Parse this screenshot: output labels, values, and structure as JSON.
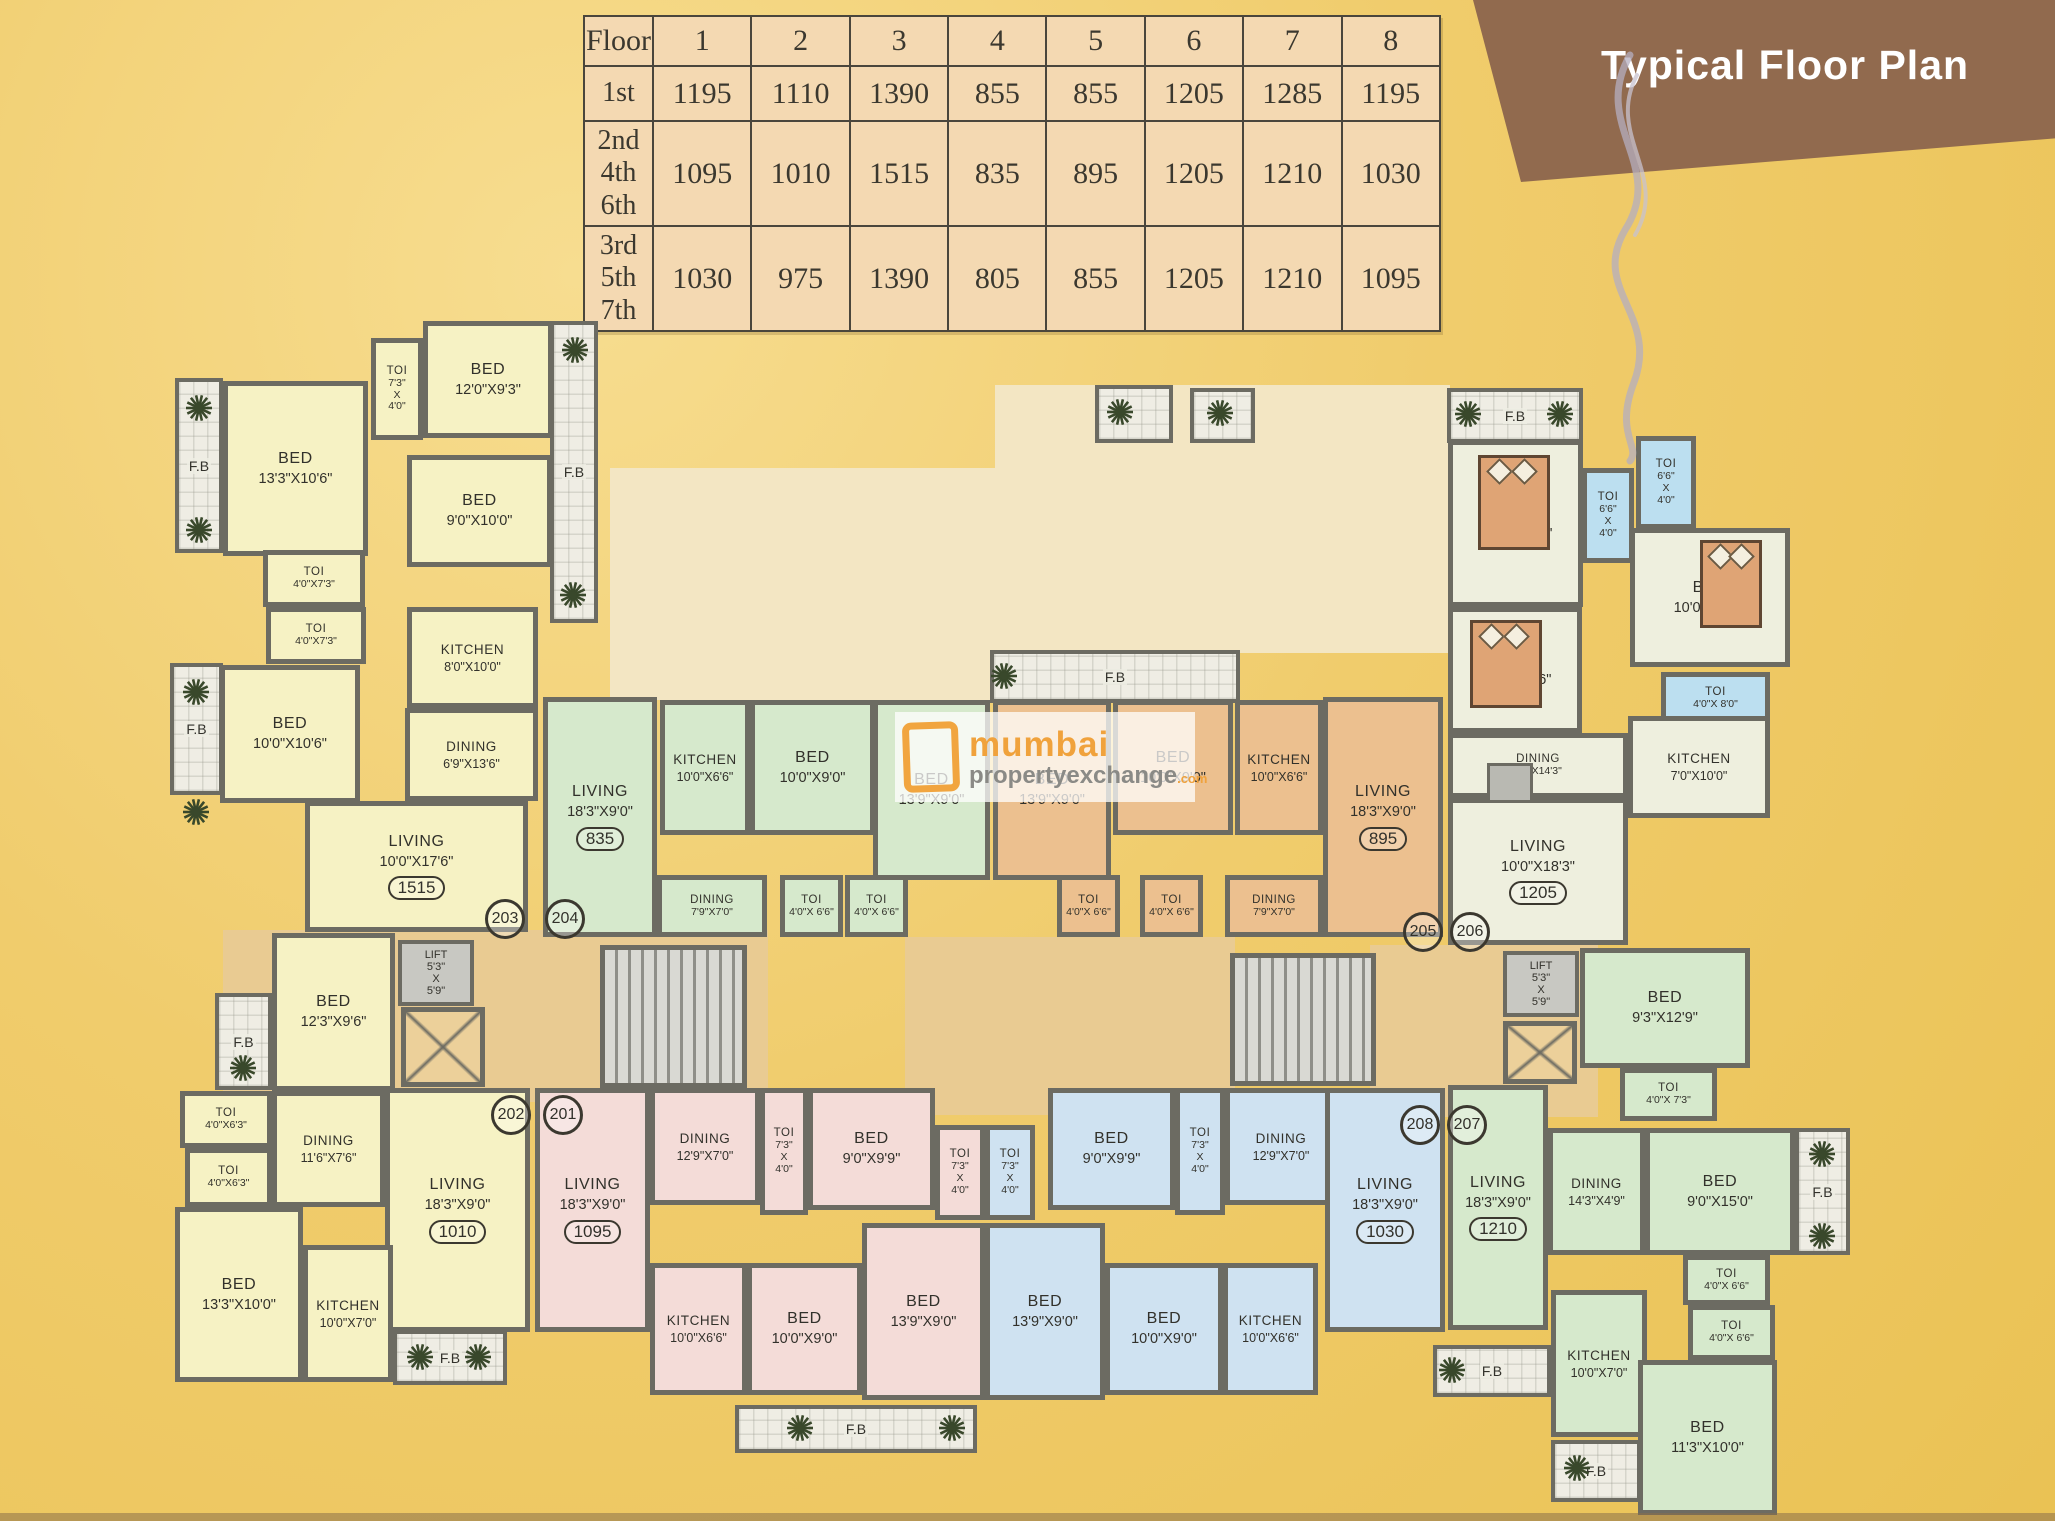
{
  "banner": {
    "title": "Typical Floor Plan"
  },
  "area_table": {
    "header": [
      "Floor",
      "1",
      "2",
      "3",
      "4",
      "5",
      "6",
      "7",
      "8"
    ],
    "rows": [
      {
        "floors": "1st",
        "values": [
          "1195",
          "1110",
          "1390",
          "855",
          "855",
          "1205",
          "1285",
          "1195"
        ]
      },
      {
        "floors": "2nd\n4th\n6th",
        "values": [
          "1095",
          "1010",
          "1515",
          "835",
          "895",
          "1205",
          "1210",
          "1030"
        ]
      },
      {
        "floors": "3rd\n5th\n7th",
        "values": [
          "1030",
          "975",
          "1390",
          "805",
          "855",
          "1205",
          "1210",
          "1095"
        ]
      }
    ]
  },
  "watermark": {
    "word1": "mumbai",
    "word2": "propertyexchange",
    "word3": ".com"
  },
  "lift_label": "LIFT\n5'3\"\nX\n5'9\"",
  "fb_label": "F.B",
  "lobbies": [
    {
      "x": 223,
      "y": 930,
      "w": 545,
      "h": 172,
      "c": "tan"
    },
    {
      "x": 905,
      "y": 937,
      "w": 330,
      "h": 178,
      "c": "tan"
    },
    {
      "x": 1370,
      "y": 945,
      "w": 228,
      "h": 172,
      "c": "tan"
    },
    {
      "x": 610,
      "y": 468,
      "w": 385,
      "h": 232,
      "c": "pale"
    },
    {
      "x": 995,
      "y": 385,
      "w": 455,
      "h": 268,
      "c": "pale"
    }
  ],
  "rooms": [
    {
      "u": "y",
      "n": "BED",
      "d": "13'3\"X10'6\"",
      "x": 223,
      "y": 381,
      "w": 145,
      "h": 175
    },
    {
      "u": "y",
      "n": "TOI",
      "d": "7'3\"\nX\n4'0\"",
      "x": 371,
      "y": 338,
      "w": 52,
      "h": 102,
      "cls": "small"
    },
    {
      "u": "y",
      "n": "BED",
      "d": "12'0\"X9'3\"",
      "x": 423,
      "y": 321,
      "w": 130,
      "h": 117
    },
    {
      "u": "y",
      "n": "BED",
      "d": "9'0\"X10'0\"",
      "x": 407,
      "y": 455,
      "w": 145,
      "h": 112
    },
    {
      "u": "y",
      "n": "TOI",
      "d": "4'0\"X7'3\"",
      "x": 263,
      "y": 550,
      "w": 102,
      "h": 57,
      "cls": "small"
    },
    {
      "u": "y",
      "n": "TOI",
      "d": "4'0\"X7'3\"",
      "x": 266,
      "y": 607,
      "w": 100,
      "h": 57,
      "cls": "small"
    },
    {
      "u": "y",
      "n": "KITCHEN",
      "d": "8'0\"X10'0\"",
      "x": 407,
      "y": 607,
      "w": 131,
      "h": 101,
      "cls": "mid"
    },
    {
      "u": "y",
      "n": "BED",
      "d": "10'0\"X10'6\"",
      "x": 220,
      "y": 665,
      "w": 140,
      "h": 138
    },
    {
      "u": "y",
      "n": "DINING",
      "d": "6'9\"X13'6\"",
      "x": 405,
      "y": 708,
      "w": 133,
      "h": 93,
      "cls": "mid"
    },
    {
      "u": "y",
      "n": "LIVING",
      "d": "10'0\"X17'6\"",
      "badge": "1515",
      "x": 305,
      "y": 801,
      "w": 223,
      "h": 131
    },
    {
      "u": "y",
      "n": "BED",
      "d": "12'3\"X9'6\"",
      "x": 272,
      "y": 933,
      "w": 123,
      "h": 158
    },
    {
      "u": "y",
      "n": "TOI",
      "d": "4'0\"X6'3\"",
      "x": 180,
      "y": 1091,
      "w": 92,
      "h": 57,
      "cls": "small"
    },
    {
      "u": "y",
      "n": "TOI",
      "d": "4'0\"X6'3\"",
      "x": 185,
      "y": 1148,
      "w": 87,
      "h": 59,
      "cls": "small"
    },
    {
      "u": "y",
      "n": "DINING",
      "d": "11'6\"X7'6\"",
      "x": 272,
      "y": 1091,
      "w": 113,
      "h": 116,
      "cls": "mid"
    },
    {
      "u": "y",
      "n": "LIVING",
      "d": "18'3\"X9'0\"",
      "badge": "1010",
      "x": 385,
      "y": 1088,
      "w": 145,
      "h": 244
    },
    {
      "u": "y",
      "n": "BED",
      "d": "13'3\"X10'0\"",
      "x": 175,
      "y": 1207,
      "w": 128,
      "h": 175
    },
    {
      "u": "y",
      "n": "KITCHEN",
      "d": "10'0\"X7'0\"",
      "x": 303,
      "y": 1245,
      "w": 90,
      "h": 137,
      "cls": "mid"
    },
    {
      "u": "g",
      "n": "LIVING",
      "d": "18'3\"X9'0\"",
      "badge": "835",
      "x": 543,
      "y": 697,
      "w": 114,
      "h": 240
    },
    {
      "u": "g",
      "n": "KITCHEN",
      "d": "10'0\"X6'6\"",
      "x": 660,
      "y": 700,
      "w": 90,
      "h": 135,
      "cls": "mid"
    },
    {
      "u": "g",
      "n": "BED",
      "d": "10'0\"X9'0\"",
      "x": 750,
      "y": 700,
      "w": 125,
      "h": 135
    },
    {
      "u": "g",
      "n": "BED",
      "d": "13'9\"X9'0\"",
      "x": 873,
      "y": 700,
      "w": 117,
      "h": 180
    },
    {
      "u": "g",
      "n": "DINING",
      "d": "7'9\"X7'0\"",
      "x": 657,
      "y": 875,
      "w": 110,
      "h": 62,
      "cls": "small"
    },
    {
      "u": "g",
      "n": "TOI",
      "d": "4'0\"X 6'6\"",
      "x": 780,
      "y": 875,
      "w": 63,
      "h": 62,
      "cls": "small"
    },
    {
      "u": "g",
      "n": "TOI",
      "d": "4'0\"X 6'6\"",
      "x": 845,
      "y": 875,
      "w": 63,
      "h": 62,
      "cls": "small"
    },
    {
      "u": "o",
      "n": "BED",
      "d": "13'9\"X9'0\"",
      "x": 993,
      "y": 700,
      "w": 118,
      "h": 180
    },
    {
      "u": "o",
      "n": "BED",
      "d": "10'0\"X9'0\"",
      "x": 1113,
      "y": 700,
      "w": 120,
      "h": 135
    },
    {
      "u": "o",
      "n": "KITCHEN",
      "d": "10'0\"X6'6\"",
      "x": 1235,
      "y": 700,
      "w": 88,
      "h": 135,
      "cls": "mid"
    },
    {
      "u": "o",
      "n": "LIVING",
      "d": "18'3\"X9'0\"",
      "badge": "895",
      "x": 1323,
      "y": 697,
      "w": 120,
      "h": 240
    },
    {
      "u": "o",
      "n": "TOI",
      "d": "4'0\"X 6'6\"",
      "x": 1057,
      "y": 875,
      "w": 63,
      "h": 62,
      "cls": "small"
    },
    {
      "u": "o",
      "n": "TOI",
      "d": "4'0\"X 6'6\"",
      "x": 1140,
      "y": 875,
      "w": 63,
      "h": 62,
      "cls": "small"
    },
    {
      "u": "o",
      "n": "DINING",
      "d": "7'9\"X7'0\"",
      "x": 1225,
      "y": 875,
      "w": 98,
      "h": 62,
      "cls": "small"
    },
    {
      "u": "s",
      "n": "BED",
      "d": "12'3\"X10'0\"",
      "x": 1448,
      "y": 440,
      "w": 135,
      "h": 167
    },
    {
      "u": "tb",
      "n": "TOI",
      "d": "6'6\"\nX\n4'0\"",
      "x": 1582,
      "y": 468,
      "w": 52,
      "h": 95,
      "cls": "small"
    },
    {
      "u": "tb",
      "n": "TOI",
      "d": "6'6\"\nX\n4'0\"",
      "x": 1636,
      "y": 436,
      "w": 60,
      "h": 93,
      "cls": "small"
    },
    {
      "u": "s",
      "n": "BED",
      "d": "10'0\"X11'3\"",
      "x": 1630,
      "y": 528,
      "w": 160,
      "h": 139
    },
    {
      "u": "tb",
      "n": "TOI",
      "d": "4'0\"X 8'0\"",
      "x": 1661,
      "y": 672,
      "w": 109,
      "h": 52,
      "cls": "small"
    },
    {
      "u": "s",
      "n": "BED",
      "d": "11'0\"X10'6\"",
      "x": 1448,
      "y": 607,
      "w": 134,
      "h": 126
    },
    {
      "u": "s",
      "n": "DINING",
      "d": "5'0\"X14'3\"",
      "x": 1448,
      "y": 733,
      "w": 180,
      "h": 65,
      "cls": "small"
    },
    {
      "u": "s",
      "n": "KITCHEN",
      "d": "7'0\"X10'0\"",
      "x": 1628,
      "y": 716,
      "w": 142,
      "h": 102,
      "cls": "mid"
    },
    {
      "u": "s",
      "n": "LIVING",
      "d": "10'0\"X18'3\"",
      "badge": "1205",
      "x": 1448,
      "y": 798,
      "w": 180,
      "h": 147
    },
    {
      "u": "g",
      "n": "LIVING",
      "d": "18'3\"X9'0\"",
      "badge": "1210",
      "x": 1448,
      "y": 1085,
      "w": 100,
      "h": 245
    },
    {
      "u": "g",
      "n": "BED",
      "d": "9'3\"X12'9\"",
      "x": 1580,
      "y": 948,
      "w": 170,
      "h": 120
    },
    {
      "u": "g",
      "n": "TOI",
      "d": "4'0\"X 7'3\"",
      "x": 1620,
      "y": 1068,
      "w": 97,
      "h": 53,
      "cls": "small"
    },
    {
      "u": "g",
      "n": "DINING",
      "d": "14'3\"X4'9\"",
      "x": 1548,
      "y": 1128,
      "w": 97,
      "h": 127,
      "cls": "mid"
    },
    {
      "u": "g",
      "n": "BED",
      "d": "9'0\"X15'0\"",
      "x": 1645,
      "y": 1128,
      "w": 150,
      "h": 127
    },
    {
      "u": "g",
      "n": "TOI",
      "d": "4'0\"X 6'6\"",
      "x": 1683,
      "y": 1255,
      "w": 87,
      "h": 50,
      "cls": "small"
    },
    {
      "u": "g",
      "n": "TOI",
      "d": "4'0\"X 6'6\"",
      "x": 1688,
      "y": 1305,
      "w": 87,
      "h": 55,
      "cls": "small"
    },
    {
      "u": "g",
      "n": "KITCHEN",
      "d": "10'0\"X7'0\"",
      "x": 1551,
      "y": 1290,
      "w": 96,
      "h": 147,
      "cls": "mid"
    },
    {
      "u": "g",
      "n": "BED",
      "d": "11'3\"X10'0\"",
      "x": 1638,
      "y": 1360,
      "w": 139,
      "h": 155
    },
    {
      "u": "p",
      "n": "LIVING",
      "d": "18'3\"X9'0\"",
      "badge": "1095",
      "x": 535,
      "y": 1088,
      "w": 115,
      "h": 244
    },
    {
      "u": "p",
      "n": "DINING",
      "d": "12'9\"X7'0\"",
      "x": 650,
      "y": 1088,
      "w": 110,
      "h": 117,
      "cls": "mid"
    },
    {
      "u": "p",
      "n": "TOI",
      "d": "7'3\"\nX\n4'0\"",
      "x": 760,
      "y": 1088,
      "w": 48,
      "h": 127,
      "cls": "small"
    },
    {
      "u": "p",
      "n": "BED",
      "d": "9'0\"X9'9\"",
      "x": 808,
      "y": 1088,
      "w": 127,
      "h": 122
    },
    {
      "u": "p",
      "n": "TOI",
      "d": "7'3\"\nX\n4'0\"",
      "x": 935,
      "y": 1125,
      "w": 50,
      "h": 95,
      "cls": "small"
    },
    {
      "u": "p",
      "n": "KITCHEN",
      "d": "10'0\"X6'6\"",
      "x": 650,
      "y": 1263,
      "w": 97,
      "h": 132,
      "cls": "mid"
    },
    {
      "u": "p",
      "n": "BED",
      "d": "10'0\"X9'0\"",
      "x": 747,
      "y": 1263,
      "w": 115,
      "h": 132
    },
    {
      "u": "p",
      "n": "BED",
      "d": "13'9\"X9'0\"",
      "x": 862,
      "y": 1223,
      "w": 123,
      "h": 177
    },
    {
      "u": "b",
      "n": "TOI",
      "d": "7'3\"\nX\n4'0\"",
      "x": 985,
      "y": 1125,
      "w": 50,
      "h": 95,
      "cls": "small"
    },
    {
      "u": "b",
      "n": "BED",
      "d": "9'0\"X9'9\"",
      "x": 1048,
      "y": 1088,
      "w": 127,
      "h": 122
    },
    {
      "u": "b",
      "n": "TOI",
      "d": "7'3\"\nX\n4'0\"",
      "x": 1175,
      "y": 1088,
      "w": 50,
      "h": 127,
      "cls": "small"
    },
    {
      "u": "b",
      "n": "DINING",
      "d": "12'9\"X7'0\"",
      "x": 1225,
      "y": 1088,
      "w": 112,
      "h": 117,
      "cls": "mid"
    },
    {
      "u": "b",
      "n": "LIVING",
      "d": "18'3\"X9'0\"",
      "badge": "1030",
      "x": 1325,
      "y": 1088,
      "w": 120,
      "h": 244
    },
    {
      "u": "b",
      "n": "BED",
      "d": "13'9\"X9'0\"",
      "x": 985,
      "y": 1223,
      "w": 120,
      "h": 177
    },
    {
      "u": "b",
      "n": "BED",
      "d": "10'0\"X9'0\"",
      "x": 1105,
      "y": 1263,
      "w": 118,
      "h": 132
    },
    {
      "u": "b",
      "n": "KITCHEN",
      "d": "10'0\"X6'6\"",
      "x": 1223,
      "y": 1263,
      "w": 95,
      "h": 132,
      "cls": "mid"
    }
  ],
  "balconies": [
    {
      "x": 175,
      "y": 378,
      "w": 48,
      "h": 175,
      "label": "F.B"
    },
    {
      "x": 550,
      "y": 321,
      "w": 48,
      "h": 302,
      "label": "F.B"
    },
    {
      "x": 170,
      "y": 663,
      "w": 53,
      "h": 132,
      "label": "F.B"
    },
    {
      "x": 215,
      "y": 993,
      "w": 57,
      "h": 97,
      "label": "F.B"
    },
    {
      "x": 393,
      "y": 1330,
      "w": 114,
      "h": 55,
      "label": "F.B"
    },
    {
      "x": 735,
      "y": 1405,
      "w": 242,
      "h": 48,
      "label": "F.B"
    },
    {
      "x": 990,
      "y": 650,
      "w": 250,
      "h": 53,
      "label": "F.B"
    },
    {
      "x": 1190,
      "y": 388,
      "w": 65,
      "h": 55,
      "label": ""
    },
    {
      "x": 1447,
      "y": 388,
      "w": 136,
      "h": 55,
      "label": "F.B"
    },
    {
      "x": 1795,
      "y": 1128,
      "w": 55,
      "h": 127,
      "label": "F.B"
    },
    {
      "x": 1433,
      "y": 1345,
      "w": 118,
      "h": 52,
      "label": "F.B"
    },
    {
      "x": 1551,
      "y": 1440,
      "w": 90,
      "h": 62,
      "label": "F.B"
    },
    {
      "x": 1095,
      "y": 385,
      "w": 78,
      "h": 58,
      "label": ""
    }
  ],
  "flowers": [
    [
      199,
      408
    ],
    [
      199,
      530
    ],
    [
      575,
      350
    ],
    [
      573,
      595
    ],
    [
      196,
      692
    ],
    [
      196,
      812
    ],
    [
      243,
      1068
    ],
    [
      420,
      1357
    ],
    [
      478,
      1357
    ],
    [
      800,
      1428
    ],
    [
      952,
      1428
    ],
    [
      1004,
      676
    ],
    [
      1220,
      413
    ],
    [
      1468,
      414
    ],
    [
      1560,
      414
    ],
    [
      1822,
      1154
    ],
    [
      1822,
      1236
    ],
    [
      1452,
      1370
    ],
    [
      1577,
      1468
    ],
    [
      1120,
      412
    ]
  ],
  "cores": {
    "lifts": [
      {
        "x": 398,
        "y": 940,
        "w": 76,
        "h": 66
      },
      {
        "x": 1503,
        "y": 951,
        "w": 76,
        "h": 66
      }
    ],
    "stairs": [
      {
        "x": 600,
        "y": 945,
        "w": 147,
        "h": 143
      },
      {
        "x": 1230,
        "y": 953,
        "w": 146,
        "h": 133
      }
    ],
    "shafts": [
      {
        "x": 401,
        "y": 1007,
        "w": 84,
        "h": 80
      },
      {
        "x": 1503,
        "y": 1021,
        "w": 74,
        "h": 63
      }
    ]
  },
  "flats": [
    {
      "no": "203",
      "x": 502,
      "y": 916
    },
    {
      "no": "204",
      "x": 562,
      "y": 916
    },
    {
      "no": "205",
      "x": 1420,
      "y": 929
    },
    {
      "no": "206",
      "x": 1467,
      "y": 929
    },
    {
      "no": "202",
      "x": 508,
      "y": 1112
    },
    {
      "no": "201",
      "x": 560,
      "y": 1112
    },
    {
      "no": "208",
      "x": 1417,
      "y": 1122
    },
    {
      "no": "207",
      "x": 1464,
      "y": 1122
    }
  ],
  "furniture": {
    "beds": [
      {
        "x": 1478,
        "y": 455,
        "w": 72,
        "h": 95
      },
      {
        "x": 1470,
        "y": 620,
        "w": 72,
        "h": 88
      },
      {
        "x": 1700,
        "y": 540,
        "w": 62,
        "h": 88
      }
    ],
    "tables": [
      {
        "x": 1487,
        "y": 763,
        "w": 46,
        "h": 40
      }
    ]
  }
}
